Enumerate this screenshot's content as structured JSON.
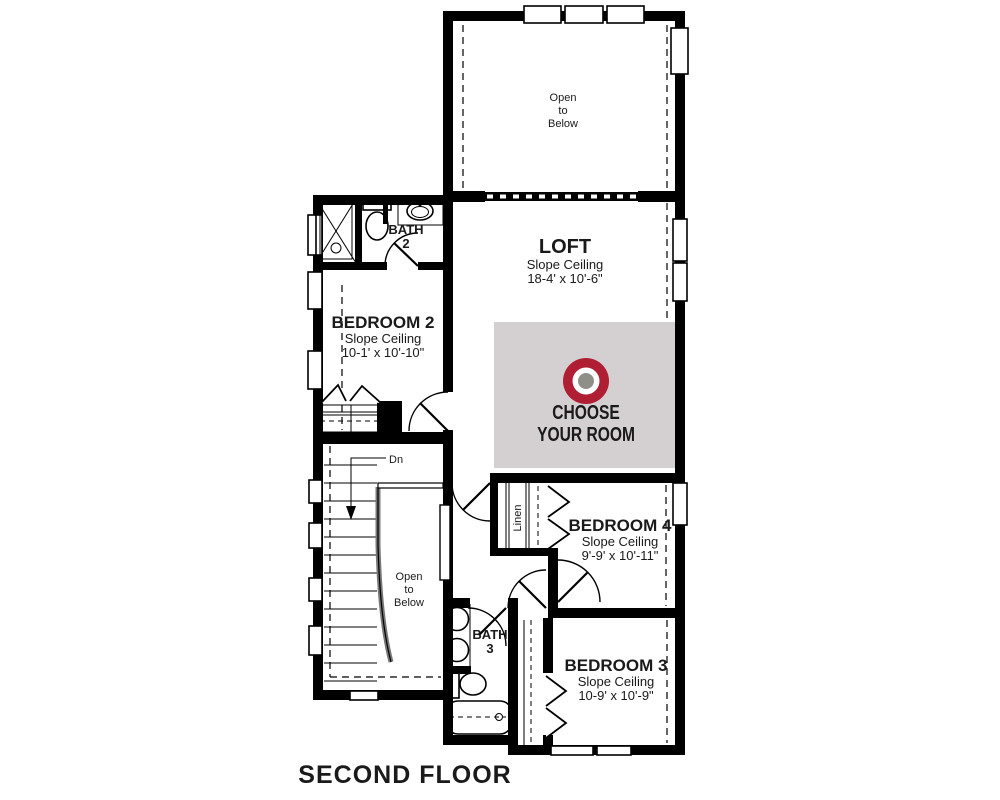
{
  "floor_title": "SECOND FLOOR",
  "colors": {
    "wall": "#000000",
    "promo_bg": "#d4d0d1",
    "accent_red": "#b01e33",
    "target_gray": "#8f8f89"
  },
  "promo": {
    "line1": "CHOOSE",
    "line2": "YOUR ROOM"
  },
  "rooms": {
    "open_below_top": {
      "l1": "Open",
      "l2": "to",
      "l3": "Below"
    },
    "loft": {
      "name": "LOFT",
      "ceiling": "Slope Ceiling",
      "dims": "18-4' x 10'-6\""
    },
    "bath2": {
      "name": "BATH",
      "number": "2"
    },
    "bedroom2": {
      "name": "BEDROOM 2",
      "ceiling": "Slope Ceiling",
      "dims": "10-1' x 10'-10\""
    },
    "stairs": {
      "dn": "Dn"
    },
    "open_below_stairs": {
      "l1": "Open",
      "l2": "to",
      "l3": "Below"
    },
    "linen": {
      "name": "Linen"
    },
    "bedroom4": {
      "name": "BEDROOM 4",
      "ceiling": "Slope Ceiling",
      "dims": "9'-9' x 10'-11\""
    },
    "bath3": {
      "name": "BATH",
      "number": "3"
    },
    "bedroom3": {
      "name": "BEDROOM 3",
      "ceiling": "Slope Ceiling",
      "dims": "10-9' x 10'-9\""
    }
  }
}
